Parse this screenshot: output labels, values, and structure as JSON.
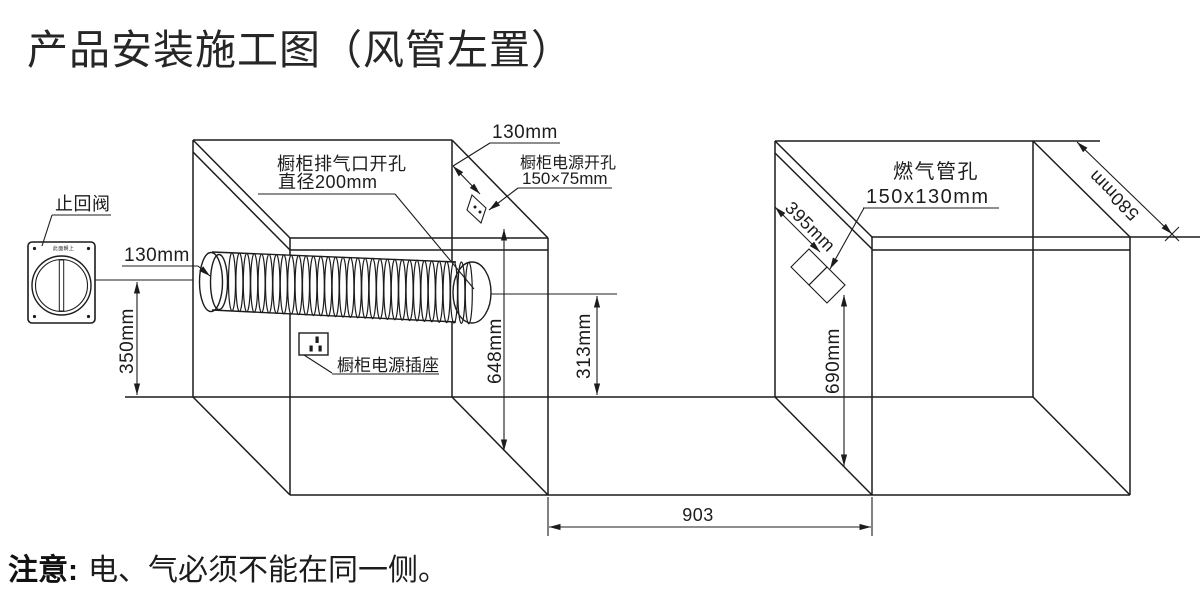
{
  "title": "产品安装施工图（风管左置）",
  "note": {
    "label": "注意:",
    "text": "电、气必须不能在同一侧。"
  },
  "labels": {
    "check_valve": "止回阀",
    "valve_plate_text": "此面朝上",
    "duct_offset": "130mm",
    "exhaust_line1": "橱柜排气口开孔",
    "exhaust_line2": "直径200mm",
    "top_offset": "130mm",
    "power_hole_line1": "橱柜电源开孔",
    "power_hole_line2": "150×75mm",
    "socket": "橱柜电源插座",
    "gas_line1": "燃气管孔",
    "gas_line2": "150x130mm"
  },
  "dimensions": {
    "valve_height": "350mm",
    "exhaust_height": "648mm",
    "counter_height": "313mm",
    "gas_height": "690mm",
    "gas_slant": "395mm",
    "depth": "580mm",
    "gap_width": "903"
  },
  "colors": {
    "line": "#1c1c1c",
    "background": "#ffffff"
  }
}
